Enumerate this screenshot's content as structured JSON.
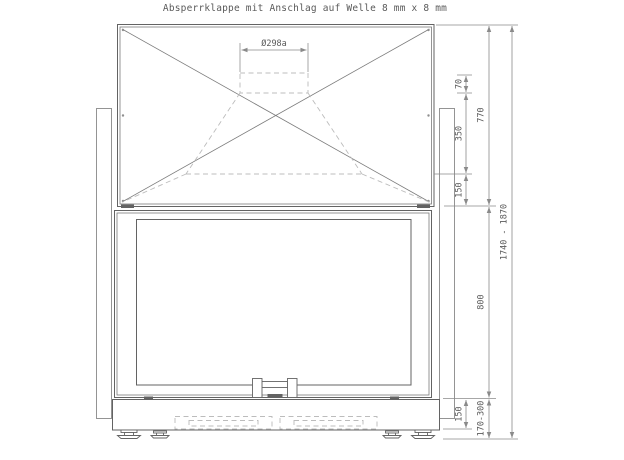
{
  "title": "Absperrklappe mit Anschlag auf Welle 8 mm x 8 mm",
  "drawing": {
    "flue_dimension": "Ø298a",
    "right_dimensions": {
      "flue_collar_height": "70",
      "hood_funnel_height": "350",
      "hood_lower_height": "150",
      "hood_total_height": "770",
      "firebox_height": "800",
      "base_height": "150",
      "foot_adjust_range": "170-300",
      "overall_height_range": "1740 - 1870"
    }
  },
  "colors": {
    "bg": "#ffffff",
    "line": "#636363",
    "line_light": "#7a7a7a",
    "dashed": "#bcbcbc",
    "dim": "#8a8a8a",
    "text": "#5a5a5a"
  }
}
